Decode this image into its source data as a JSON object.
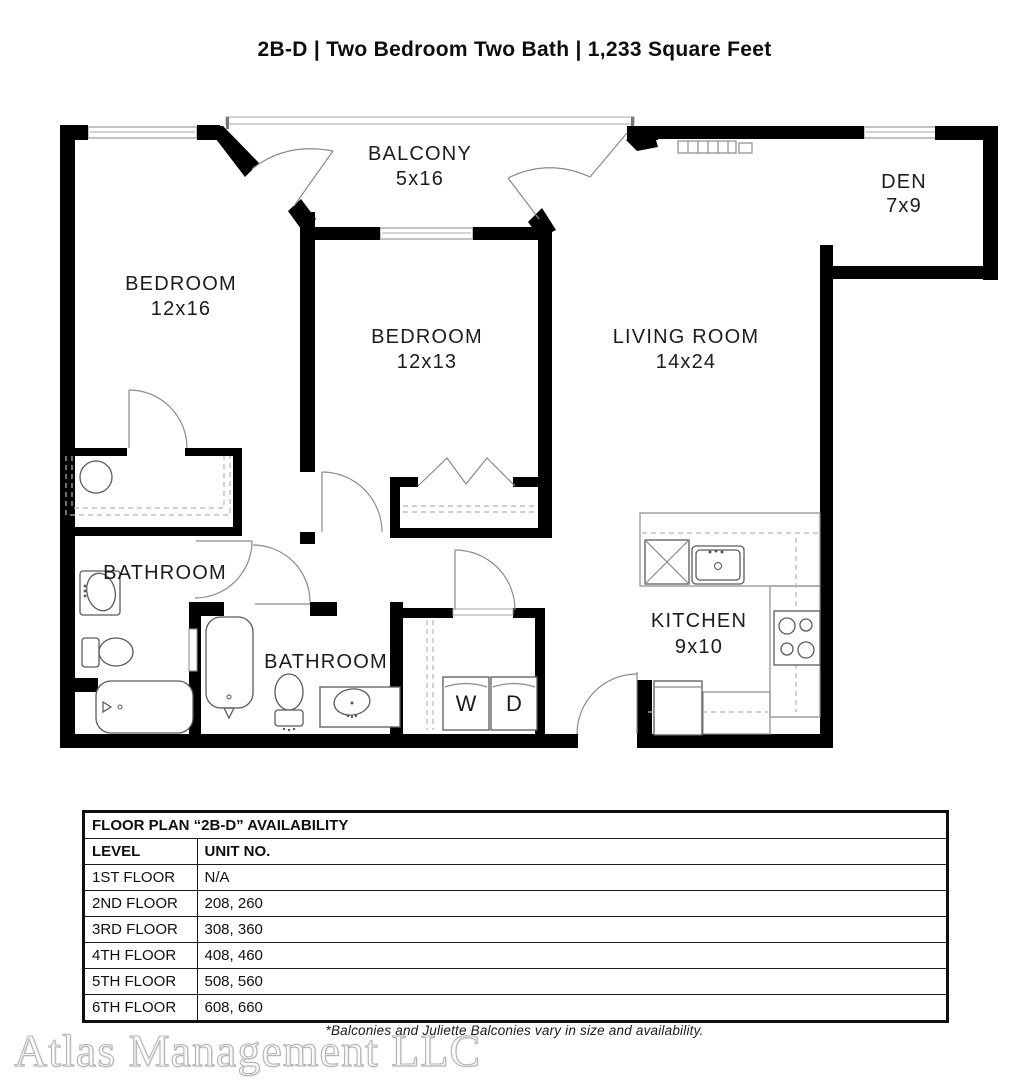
{
  "title": "2B-D | Two Bedroom Two Bath | 1,233 Square Feet",
  "rooms": {
    "balcony": {
      "name": "BALCONY",
      "dims": "5x16"
    },
    "den": {
      "name": "DEN",
      "dims": "7x9"
    },
    "bedroom1": {
      "name": "BEDROOM",
      "dims": "12x16"
    },
    "bedroom2": {
      "name": "BEDROOM",
      "dims": "12x13"
    },
    "living": {
      "name": "LIVING ROOM",
      "dims": "14x24"
    },
    "kitchen": {
      "name": "KITCHEN",
      "dims": "9x10"
    },
    "bathroom1": {
      "name": "BATHROOM"
    },
    "bathroom2": {
      "name": "BATHROOM"
    },
    "washer": "W",
    "dryer": "D"
  },
  "availability": {
    "title": "FLOOR PLAN “2B-D” AVAILABILITY",
    "columns": {
      "level": "LEVEL",
      "unit": "UNIT NO."
    },
    "rows": [
      {
        "level": "1ST FLOOR",
        "unit": "N/A"
      },
      {
        "level": "2ND FLOOR",
        "unit": "208, 260"
      },
      {
        "level": "3RD FLOOR",
        "unit": "308, 360"
      },
      {
        "level": "4TH FLOOR",
        "unit": "408, 460"
      },
      {
        "level": "5TH FLOOR",
        "unit": "508, 560"
      },
      {
        "level": "6TH FLOOR",
        "unit": "608, 660"
      }
    ]
  },
  "footnote": "*Balconies and Juliette Balconies vary in size and availability.",
  "watermark": "Atlas Management LLC",
  "colors": {
    "wall": "#000000",
    "text": "#1c1c1c",
    "background": "#ffffff"
  }
}
